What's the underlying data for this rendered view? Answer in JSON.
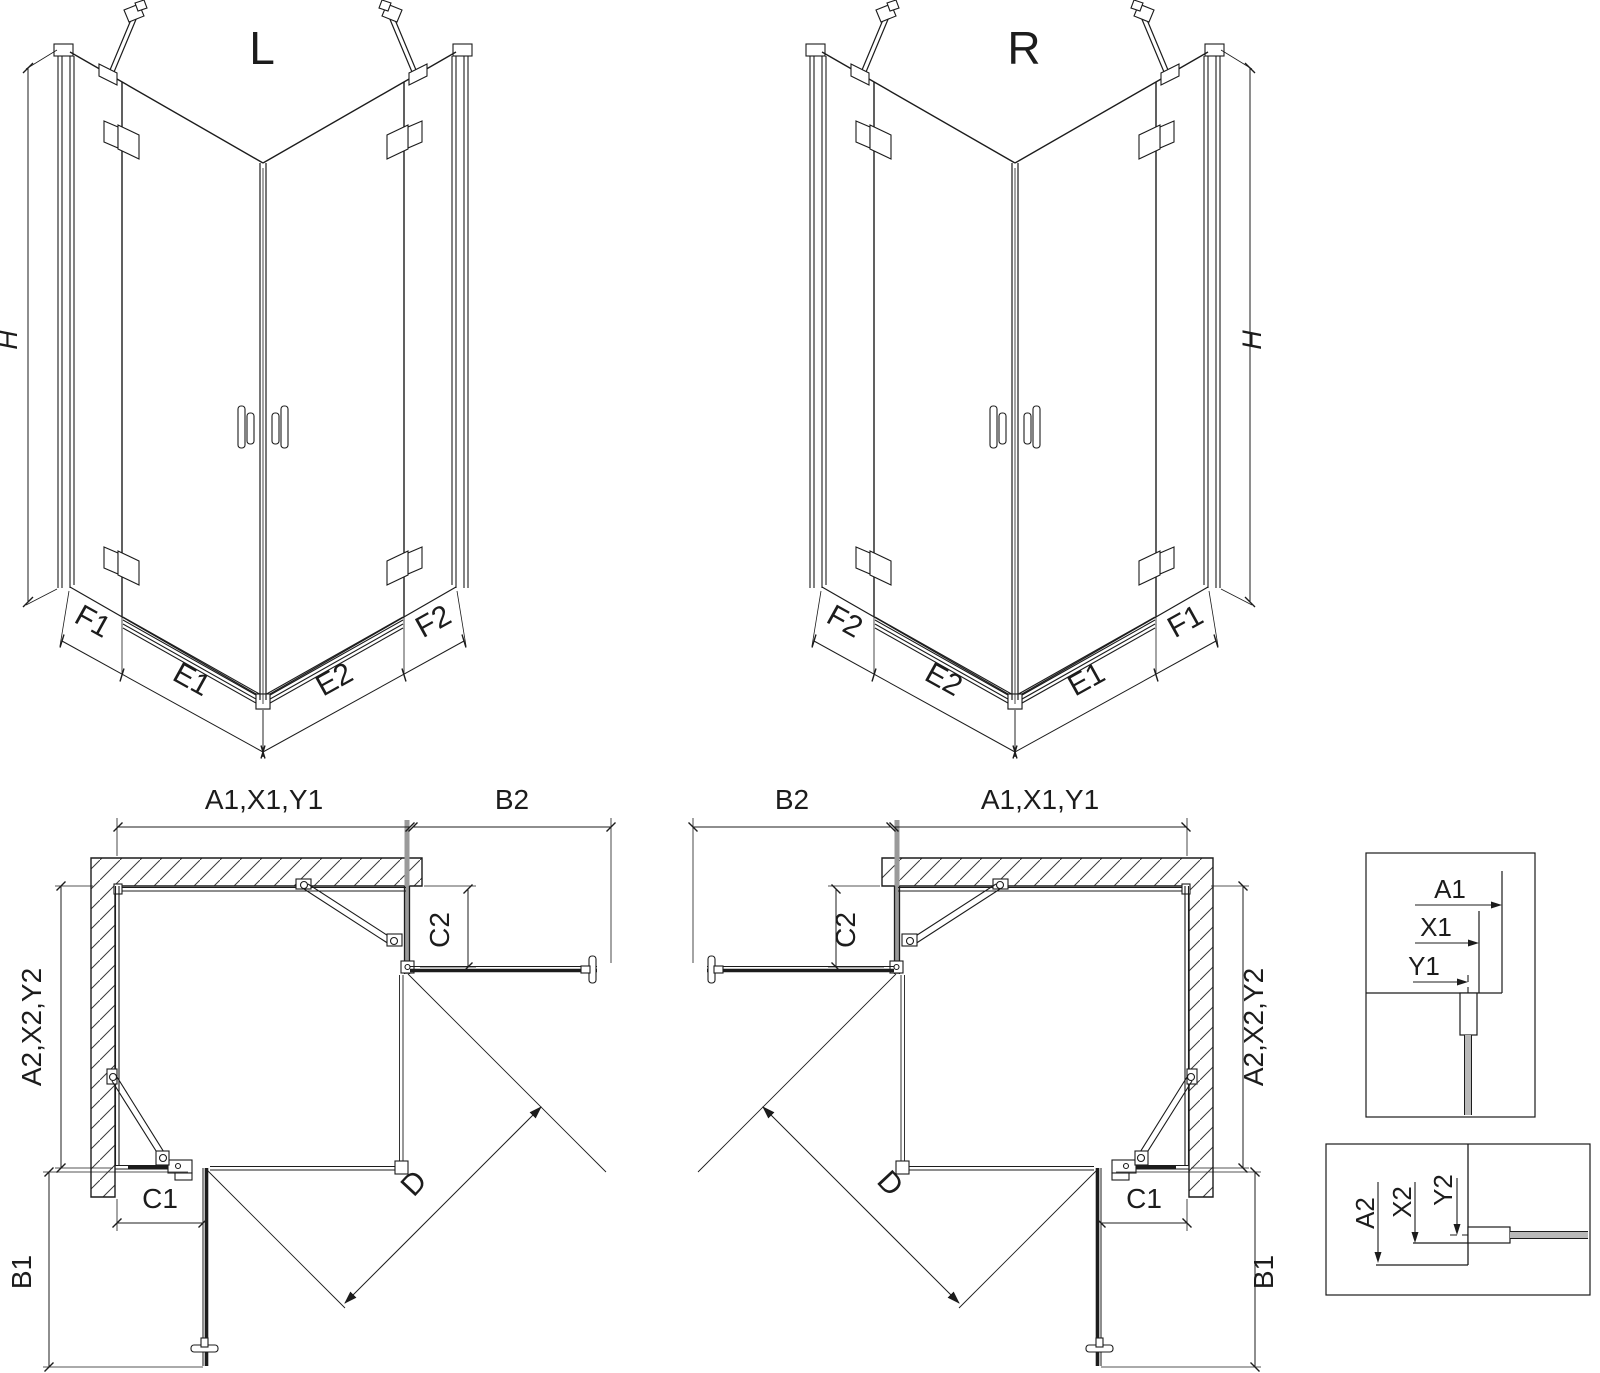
{
  "drawing": {
    "title": "Corner shower enclosure technical drawing",
    "views": {
      "left_3d_label": "L",
      "right_3d_label": "R"
    },
    "dims": {
      "h": "H",
      "f1": "F1",
      "e1": "E1",
      "e2": "E2",
      "f2": "F2",
      "a1_group": "A1,X1,Y1",
      "b2": "B2",
      "c2": "C2",
      "a2_group": "A2,X2,Y2",
      "c1": "C1",
      "b1": "B1",
      "d": "D"
    },
    "detail1": {
      "a1": "A1",
      "x1": "X1",
      "y1": "Y1"
    },
    "detail2": {
      "a2": "A2",
      "x2": "X2",
      "y2": "Y2"
    },
    "colors": {
      "line": "#1c1c1c",
      "hatch": "#3a3a3a",
      "bold_profile_gray": "#9a9a9a",
      "glass_gray": "#b9b9b9",
      "background": "#ffffff"
    }
  }
}
